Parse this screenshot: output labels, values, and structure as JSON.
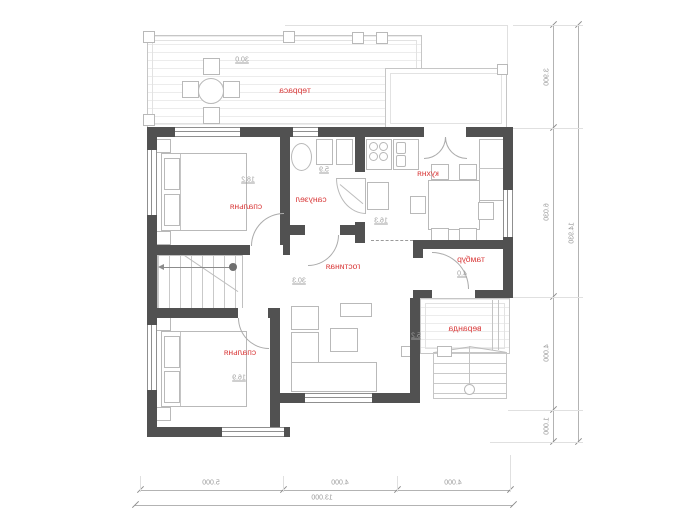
{
  "plan": {
    "rooms": [
      {
        "id": "terrace-top",
        "label": "терраса",
        "area": "30.0"
      },
      {
        "id": "bedroom-top",
        "label": "спальня",
        "area": "18.2"
      },
      {
        "id": "bathroom",
        "label": "санузел",
        "area": "5.9"
      },
      {
        "id": "kitchen",
        "label": "кухня",
        "area": "16.3"
      },
      {
        "id": "living-room",
        "label": "гостиная",
        "area": "30.3"
      },
      {
        "id": "vestibule",
        "label": "тамбур",
        "area": "4.0"
      },
      {
        "id": "bedroom-bottom",
        "label": "спальня",
        "area": "16.9"
      },
      {
        "id": "veranda",
        "label": "веранда",
        "area": "5.2"
      }
    ],
    "dimensions": {
      "right": {
        "segments": [
          "3.900",
          "6.030",
          "4.000",
          "1.000"
        ],
        "total": "14.930"
      },
      "bottom": {
        "segments": [
          "5.000",
          "4.000",
          "4.000"
        ],
        "total": "13.000"
      }
    },
    "colors": {
      "wall": "#515151",
      "room_label": "#d93a3a",
      "thin_line": "#b9b9b9",
      "dim_text": "#9b9b9b"
    }
  }
}
